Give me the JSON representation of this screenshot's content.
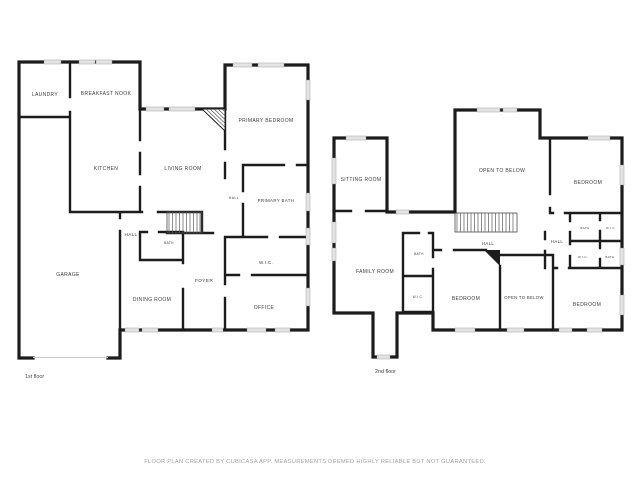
{
  "colors": {
    "wall": "#1c1c1c",
    "window": "#e4e4e4",
    "room_label": "#3d3d3d",
    "disclaimer_text": "#a3a3a3",
    "background": "#ffffff"
  },
  "floors": [
    {
      "floor_label": "1st floor",
      "rooms": [
        {
          "label": "LAUNDRY"
        },
        {
          "label": "BREAKFAST NOOK"
        },
        {
          "label": "KITCHEN"
        },
        {
          "label": "LIVING ROOM"
        },
        {
          "label": "PRIMARY BEDROOM"
        },
        {
          "label": "HALL"
        },
        {
          "label": "PRIMARY BATH"
        },
        {
          "label": "HALL"
        },
        {
          "label": "BATH"
        },
        {
          "label": "GARAGE"
        },
        {
          "label": "DINING ROOM"
        },
        {
          "label": "FOYER"
        },
        {
          "label": "W.I.C."
        },
        {
          "label": "OFFICE"
        }
      ]
    },
    {
      "floor_label": "2nd floor",
      "rooms": [
        {
          "label": "SITTING ROOM"
        },
        {
          "label": "OPEN TO BELOW"
        },
        {
          "label": "BEDROOM"
        },
        {
          "label": "FAMILY ROOM"
        },
        {
          "label": "HALL"
        },
        {
          "label": "HALL"
        },
        {
          "label": "BATH"
        },
        {
          "label": "W.I.C."
        },
        {
          "label": "BATH"
        },
        {
          "label": "W.I.C."
        },
        {
          "label": "W.I.C."
        },
        {
          "label": "BATH"
        },
        {
          "label": "BEDROOM"
        },
        {
          "label": "OPEN TO BELOW"
        },
        {
          "label": "BEDROOM"
        }
      ]
    }
  ],
  "footer": {
    "disclaimer": "FLOOR PLAN CREATED BY CUBICASA APP. MEASUREMENTS DEEMED HIGHLY RELIABLE BUT NOT GUARANTEED."
  }
}
